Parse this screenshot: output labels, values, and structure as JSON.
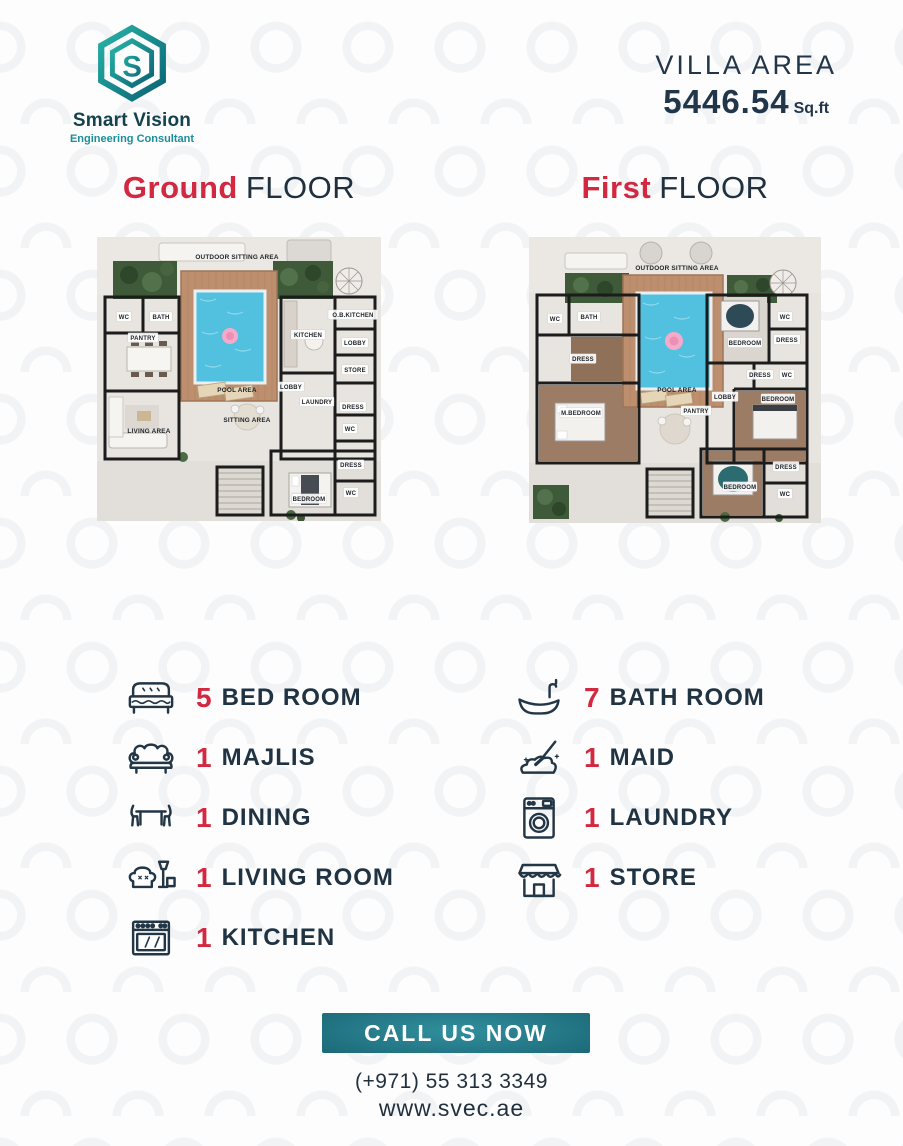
{
  "header": {
    "brand": "Smart Vision",
    "tagline": "Engineering Consultant",
    "logo_letter": "S",
    "villa_area_label": "VILLA AREA",
    "villa_area_value": "5446.54",
    "villa_area_unit": "Sq.ft"
  },
  "floors": [
    {
      "title_accent": "Ground",
      "title_rest": "FLOOR",
      "rooms": [
        {
          "label": "OUTDOOR SITTING AREA",
          "x": 140,
          "y": 20
        },
        {
          "label": "WC",
          "x": 27,
          "y": 80
        },
        {
          "label": "BATH",
          "x": 64,
          "y": 80
        },
        {
          "label": "PANTRY",
          "x": 46,
          "y": 101
        },
        {
          "label": "KITCHEN",
          "x": 211,
          "y": 98
        },
        {
          "label": "O.B.KITCHEN",
          "x": 256,
          "y": 78
        },
        {
          "label": "LOBBY",
          "x": 258,
          "y": 106
        },
        {
          "label": "STORE",
          "x": 258,
          "y": 133
        },
        {
          "label": "POOL AREA",
          "x": 140,
          "y": 153
        },
        {
          "label": "LOBBY",
          "x": 194,
          "y": 150
        },
        {
          "label": "LAUNDRY",
          "x": 220,
          "y": 165
        },
        {
          "label": "DRESS",
          "x": 256,
          "y": 170
        },
        {
          "label": "WC",
          "x": 253,
          "y": 192
        },
        {
          "label": "SITTING AREA",
          "x": 150,
          "y": 183
        },
        {
          "label": "LIVING AREA",
          "x": 52,
          "y": 194
        },
        {
          "label": "DRESS",
          "x": 254,
          "y": 228
        },
        {
          "label": "WC",
          "x": 254,
          "y": 256
        },
        {
          "label": "BEDROOM",
          "x": 212,
          "y": 262
        }
      ]
    },
    {
      "title_accent": "First",
      "title_rest": "FLOOR",
      "rooms": [
        {
          "label": "OUTDOOR SITTING AREA",
          "x": 148,
          "y": 31
        },
        {
          "label": "WC",
          "x": 26,
          "y": 82
        },
        {
          "label": "BATH",
          "x": 60,
          "y": 80
        },
        {
          "label": "DRESS",
          "x": 54,
          "y": 122
        },
        {
          "label": "M.BEDROOM",
          "x": 52,
          "y": 176
        },
        {
          "label": "POOL AREA",
          "x": 148,
          "y": 153
        },
        {
          "label": "BEDROOM",
          "x": 216,
          "y": 106
        },
        {
          "label": "WC",
          "x": 256,
          "y": 80
        },
        {
          "label": "DRESS",
          "x": 258,
          "y": 103
        },
        {
          "label": "DRESS",
          "x": 231,
          "y": 138
        },
        {
          "label": "WC",
          "x": 258,
          "y": 138
        },
        {
          "label": "LOBBY",
          "x": 196,
          "y": 160
        },
        {
          "label": "PANTRY",
          "x": 167,
          "y": 174
        },
        {
          "label": "BEDROOM",
          "x": 249,
          "y": 162
        },
        {
          "label": "DRESS",
          "x": 257,
          "y": 230
        },
        {
          "label": "WC",
          "x": 256,
          "y": 257
        },
        {
          "label": "BEDROOM",
          "x": 211,
          "y": 250
        }
      ]
    }
  ],
  "features": {
    "left": [
      {
        "icon": "bed-icon",
        "count": "5",
        "label": "BED ROOM"
      },
      {
        "icon": "sofa-icon",
        "count": "1",
        "label": "MAJLIS"
      },
      {
        "icon": "dining-icon",
        "count": "1",
        "label": "DINING"
      },
      {
        "icon": "living-icon",
        "count": "1",
        "label": "LIVING ROOM"
      },
      {
        "icon": "stove-icon",
        "count": "1",
        "label": "KITCHEN"
      }
    ],
    "right": [
      {
        "icon": "bathtub-icon",
        "count": "7",
        "label": "BATH ROOM"
      },
      {
        "icon": "maid-icon",
        "count": "1",
        "label": "MAID"
      },
      {
        "icon": "washer-icon",
        "count": "1",
        "label": "LAUNDRY"
      },
      {
        "icon": "store-icon",
        "count": "1",
        "label": "STORE"
      }
    ]
  },
  "footer": {
    "cta": "CALL US NOW",
    "phone": "(+971) 55 313 3349",
    "website": "www.svec.ae"
  },
  "colors": {
    "accent_red": "#d22840",
    "navy": "#203342",
    "teal_dark": "#113f4c",
    "teal_light": "#27b3a6"
  }
}
